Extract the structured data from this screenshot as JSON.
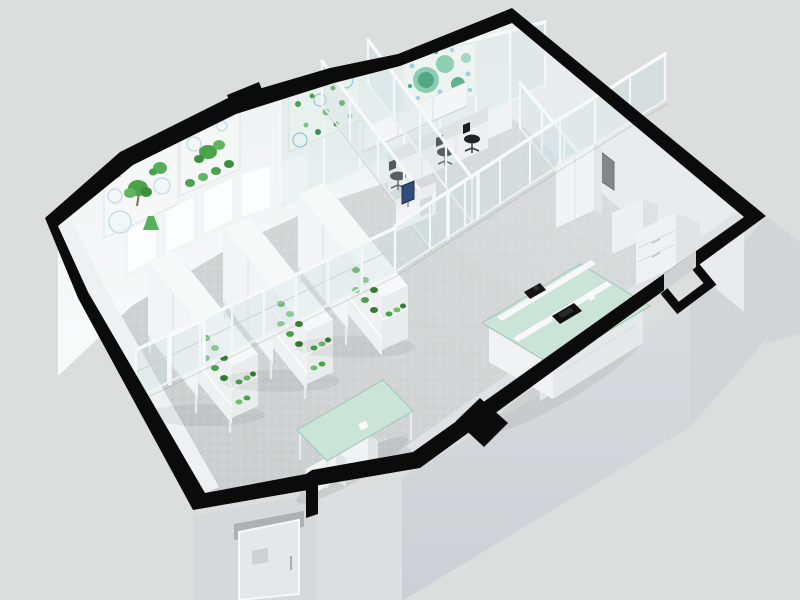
{
  "page": {
    "title": "3D laboratory floor plan render"
  },
  "palette": {
    "background": "#dcdddd",
    "wall_cut": "#0b0b0b",
    "floor_base": "#c8cbcb",
    "wall_white": "#f1f4f5",
    "exterior_wall": "#d5d8db",
    "glass_frame": "#f5f7f8",
    "mint": "#cbe4d8",
    "plant_green": "#4aa34a",
    "poster_teal": "#7cc4a8",
    "chair_black": "#232323",
    "monitor_blue": "#2e4d7b",
    "window_glow": "#fbfdfe",
    "panel_gray": "#82878c",
    "door_face": "#e5e8ea"
  },
  "scene": {
    "view": "isometric cutaway",
    "areas": [
      "plant-growth-room",
      "corridor",
      "workstation-room",
      "instrument-room",
      "open-lab-area",
      "entry-vestibule"
    ],
    "objects": [
      {
        "name": "wall-poster-botany-1",
        "desc": "plant research poster with trees, petri dishes and flask"
      },
      {
        "name": "wall-poster-botany-2",
        "desc": "poster with green shrubs and circles"
      },
      {
        "name": "glass-poster-cells",
        "desc": "poster with scattered green cell dots on glass wall"
      },
      {
        "name": "glass-poster-colonies",
        "desc": "poster with teal microbial colony circles"
      },
      {
        "name": "grow-rack",
        "count": 3
      },
      {
        "name": "office-chair",
        "count": 3
      },
      {
        "name": "microscope",
        "count": 2
      },
      {
        "name": "island-bench",
        "count": 1
      },
      {
        "name": "mint-table",
        "count": 1
      },
      {
        "name": "window-pane",
        "count": 5
      },
      {
        "name": "exterior-door",
        "count": 1
      },
      {
        "name": "storage-cabinet",
        "count": 3
      }
    ]
  }
}
